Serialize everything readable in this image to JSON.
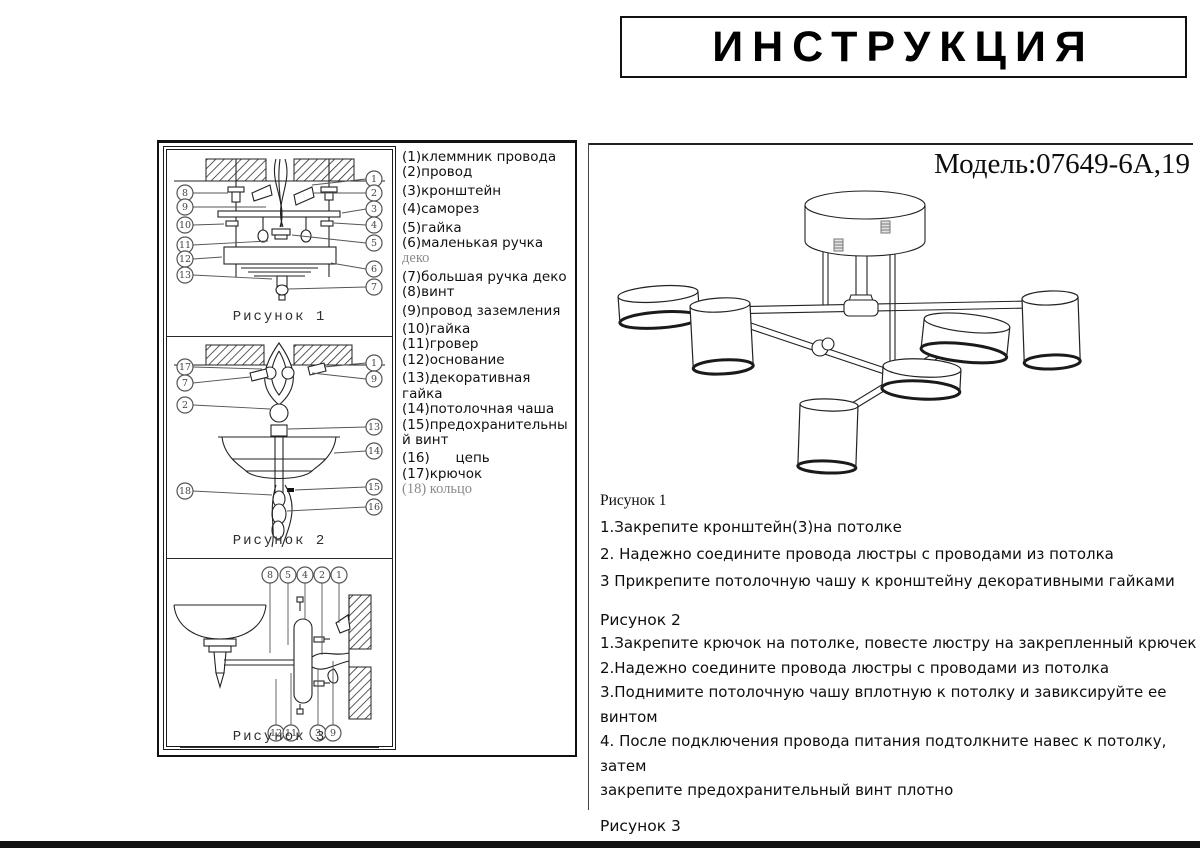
{
  "title": "ИНСТРУКЦИЯ",
  "model": "Модель:07649-6А,19",
  "parts_list": {
    "lines": [
      {
        "t": "(1)клеммник провода"
      },
      {
        "t": "(2)провод"
      },
      {
        "t": "(3)кронштейн",
        "gap": true
      },
      {
        "t": "(4)саморез",
        "gap": true
      },
      {
        "t": "(5)гайка",
        "gap": true
      },
      {
        "t": "(6)маленькая ручка"
      },
      {
        "t": "деко",
        "muted": true
      },
      {
        "t": "(7)большая ручка деко",
        "gap": true
      },
      {
        "t": "(8)винт"
      },
      {
        "t": "(9)провод заземления",
        "gap": true
      },
      {
        "t": "(10)гайка",
        "gap": true
      },
      {
        "t": "(11)гровер"
      },
      {
        "t": "(12)основание"
      },
      {
        "t": "(13)декоративная",
        "gap": true
      },
      {
        "t": "гайка"
      },
      {
        "t": "(14)потолочная чаша"
      },
      {
        "t": "(15)предохранительны"
      },
      {
        "t": "й винт"
      },
      {
        "t": "(16)      цепь",
        "gap": true
      },
      {
        "t": "(17)крючок"
      },
      {
        "t": "(18) кольцо",
        "muted": true
      }
    ]
  },
  "figures_panel": {
    "fig1_caption": "Рисунок 1",
    "fig2_caption": "Рисунок 2",
    "fig3_caption": "Рисунок 3",
    "fig1_left": [
      "8",
      "9",
      "10",
      "11",
      "12",
      "13"
    ],
    "fig1_right": [
      "1",
      "2",
      "3",
      "4",
      "5",
      "6",
      "7"
    ],
    "fig2_left": [
      "17",
      "7",
      "2",
      "18"
    ],
    "fig2_right": [
      "1",
      "9",
      "13",
      "14",
      "15",
      "16"
    ],
    "fig3_top": [
      "8",
      "5",
      "4",
      "2",
      "1"
    ],
    "fig3_bottom": [
      "12",
      "11",
      "3",
      "9"
    ]
  },
  "instructions": {
    "fig1_heading": "Рисунок 1",
    "fig1_lines": [
      "1.Закрепите кронштейн(3)на потолке",
      "2. Надежно соедините провода люстры с проводами из потолка",
      "3 Прикрепите потолочную чашу к кронштейну декоративными гайками"
    ],
    "fig2_heading": "Рисунок 2",
    "fig2_lines": [
      "1.Закрепите крючок на потолке, повесте люстру на закрепленный крючек",
      "2.Надежно соедините провода люстры с проводами из потолка",
      "3.Поднимите потолочную чашу вплотную к потолку и завиксируйте ее",
      "винтом",
      "4. После подключения провода питания подтолкните навес к потолку, затем",
      "закрепите предохранительный винт плотно"
    ],
    "fig3_heading": "Рисунок 3",
    "fig3_lines": [
      "способ установки аналогичный рисунку 1"
    ]
  },
  "colors": {
    "ink": "#111111",
    "callout": "#555555",
    "muted_text": "#8a8a8a"
  }
}
